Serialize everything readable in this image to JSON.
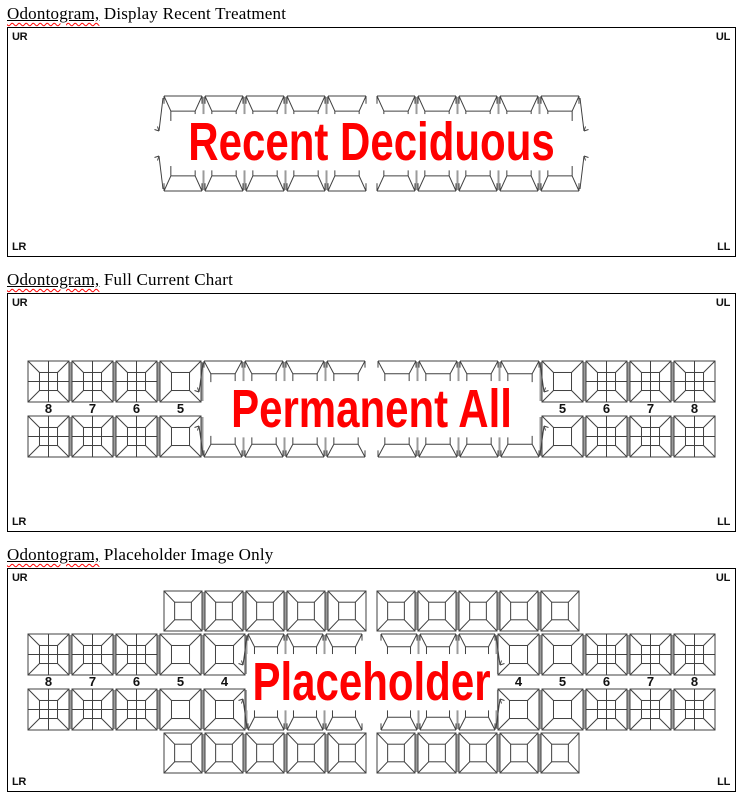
{
  "document": {
    "background": "#ffffff"
  },
  "colors": {
    "overlay_text": "#ff0000",
    "tooth_line": "#404040",
    "tooth_separator": "#9b9b9b",
    "panel_border": "#000000",
    "squiggle": "#ff0000",
    "label_text": "#111111"
  },
  "panels": [
    {
      "id": "recent",
      "title_word": "Odontogram,",
      "title_rest": " Display Recent Treatment",
      "overlay_text": "Recent Deciduous",
      "corners": {
        "top_left": "UR",
        "top_right": "UL",
        "bottom_left": "LR",
        "bottom_right": "LL"
      },
      "teeth": {
        "arch_style": "deciduous_bands_only",
        "quadrant_types": [
          "band",
          "band",
          "band",
          "band",
          "band"
        ],
        "tooth_labels": [
          "",
          "",
          "",
          "",
          ""
        ]
      }
    },
    {
      "id": "full",
      "title_word": "Odontogram,",
      "title_rest": " Full Current Chart",
      "overlay_text": "Permanent All",
      "corners": {
        "top_left": "UR",
        "top_right": "UL",
        "bottom_left": "LR",
        "bottom_right": "LL"
      },
      "teeth": {
        "arch_style": "permanent_all",
        "quadrant_types": [
          "molar",
          "molar",
          "molar",
          "bicuspid",
          "band",
          "band",
          "band",
          "band"
        ],
        "tooth_labels": [
          "8",
          "7",
          "6",
          "5",
          "",
          "",
          "",
          ""
        ]
      }
    },
    {
      "id": "placeholder",
      "title_word": "Odontogram,",
      "title_rest": " Placeholder Image Only",
      "overlay_text": "Placeholder",
      "corners": {
        "top_left": "UR",
        "top_right": "UL",
        "bottom_left": "LR",
        "bottom_right": "LL"
      },
      "teeth": {
        "arch_style": "permanent_and_deciduous",
        "quadrant_types": [
          "molar",
          "molar",
          "molar",
          "bicuspid",
          "bicuspid",
          "band",
          "band",
          "band"
        ],
        "tooth_labels": [
          "8",
          "7",
          "6",
          "5",
          "4",
          "",
          "",
          ""
        ],
        "deciduous_quadrant_types": [
          "square",
          "square",
          "square",
          "square",
          "square"
        ]
      }
    }
  ]
}
